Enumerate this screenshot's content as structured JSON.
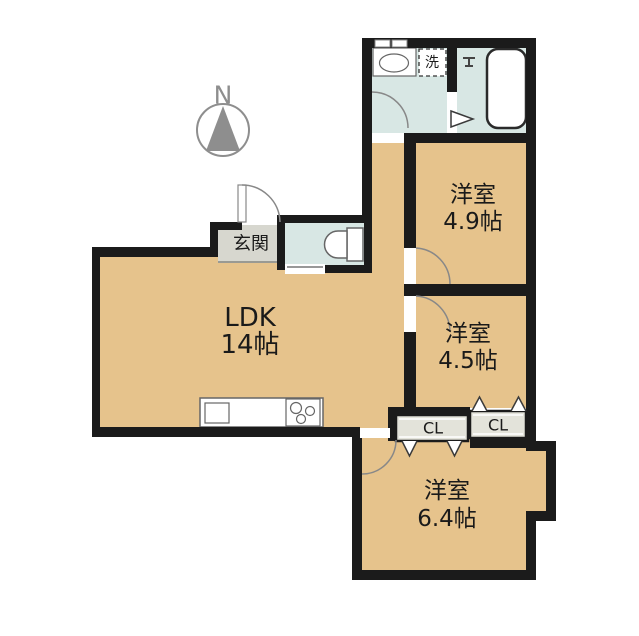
{
  "plan": {
    "type": "apartment-floor-plan"
  },
  "colors": {
    "background": "#ffffff",
    "wall": "#1b1b1b",
    "floor_room": "#e6c38c",
    "floor_wet": "#d8e7e4",
    "floor_entry": "#d7d7cf",
    "floor_closet": "#e3e3da",
    "door_line": "#888888",
    "fixture_stroke": "#666666",
    "compass": "#8e8e8e",
    "text_color": "#1a1a1a"
  },
  "compass": {
    "label": "N"
  },
  "rooms": {
    "ldk": {
      "name": "LDK",
      "size": "14帖"
    },
    "bedroom_49": {
      "name": "洋室",
      "size": "4.9帖"
    },
    "bedroom_45": {
      "name": "洋室",
      "size": "4.5帖"
    },
    "bedroom_64": {
      "name": "洋室",
      "size": "6.4帖"
    },
    "entrance": {
      "name": "玄関"
    },
    "washer": {
      "name": "洗"
    },
    "closet_left": {
      "label": "CL"
    },
    "closet_right": {
      "label": "CL"
    }
  }
}
